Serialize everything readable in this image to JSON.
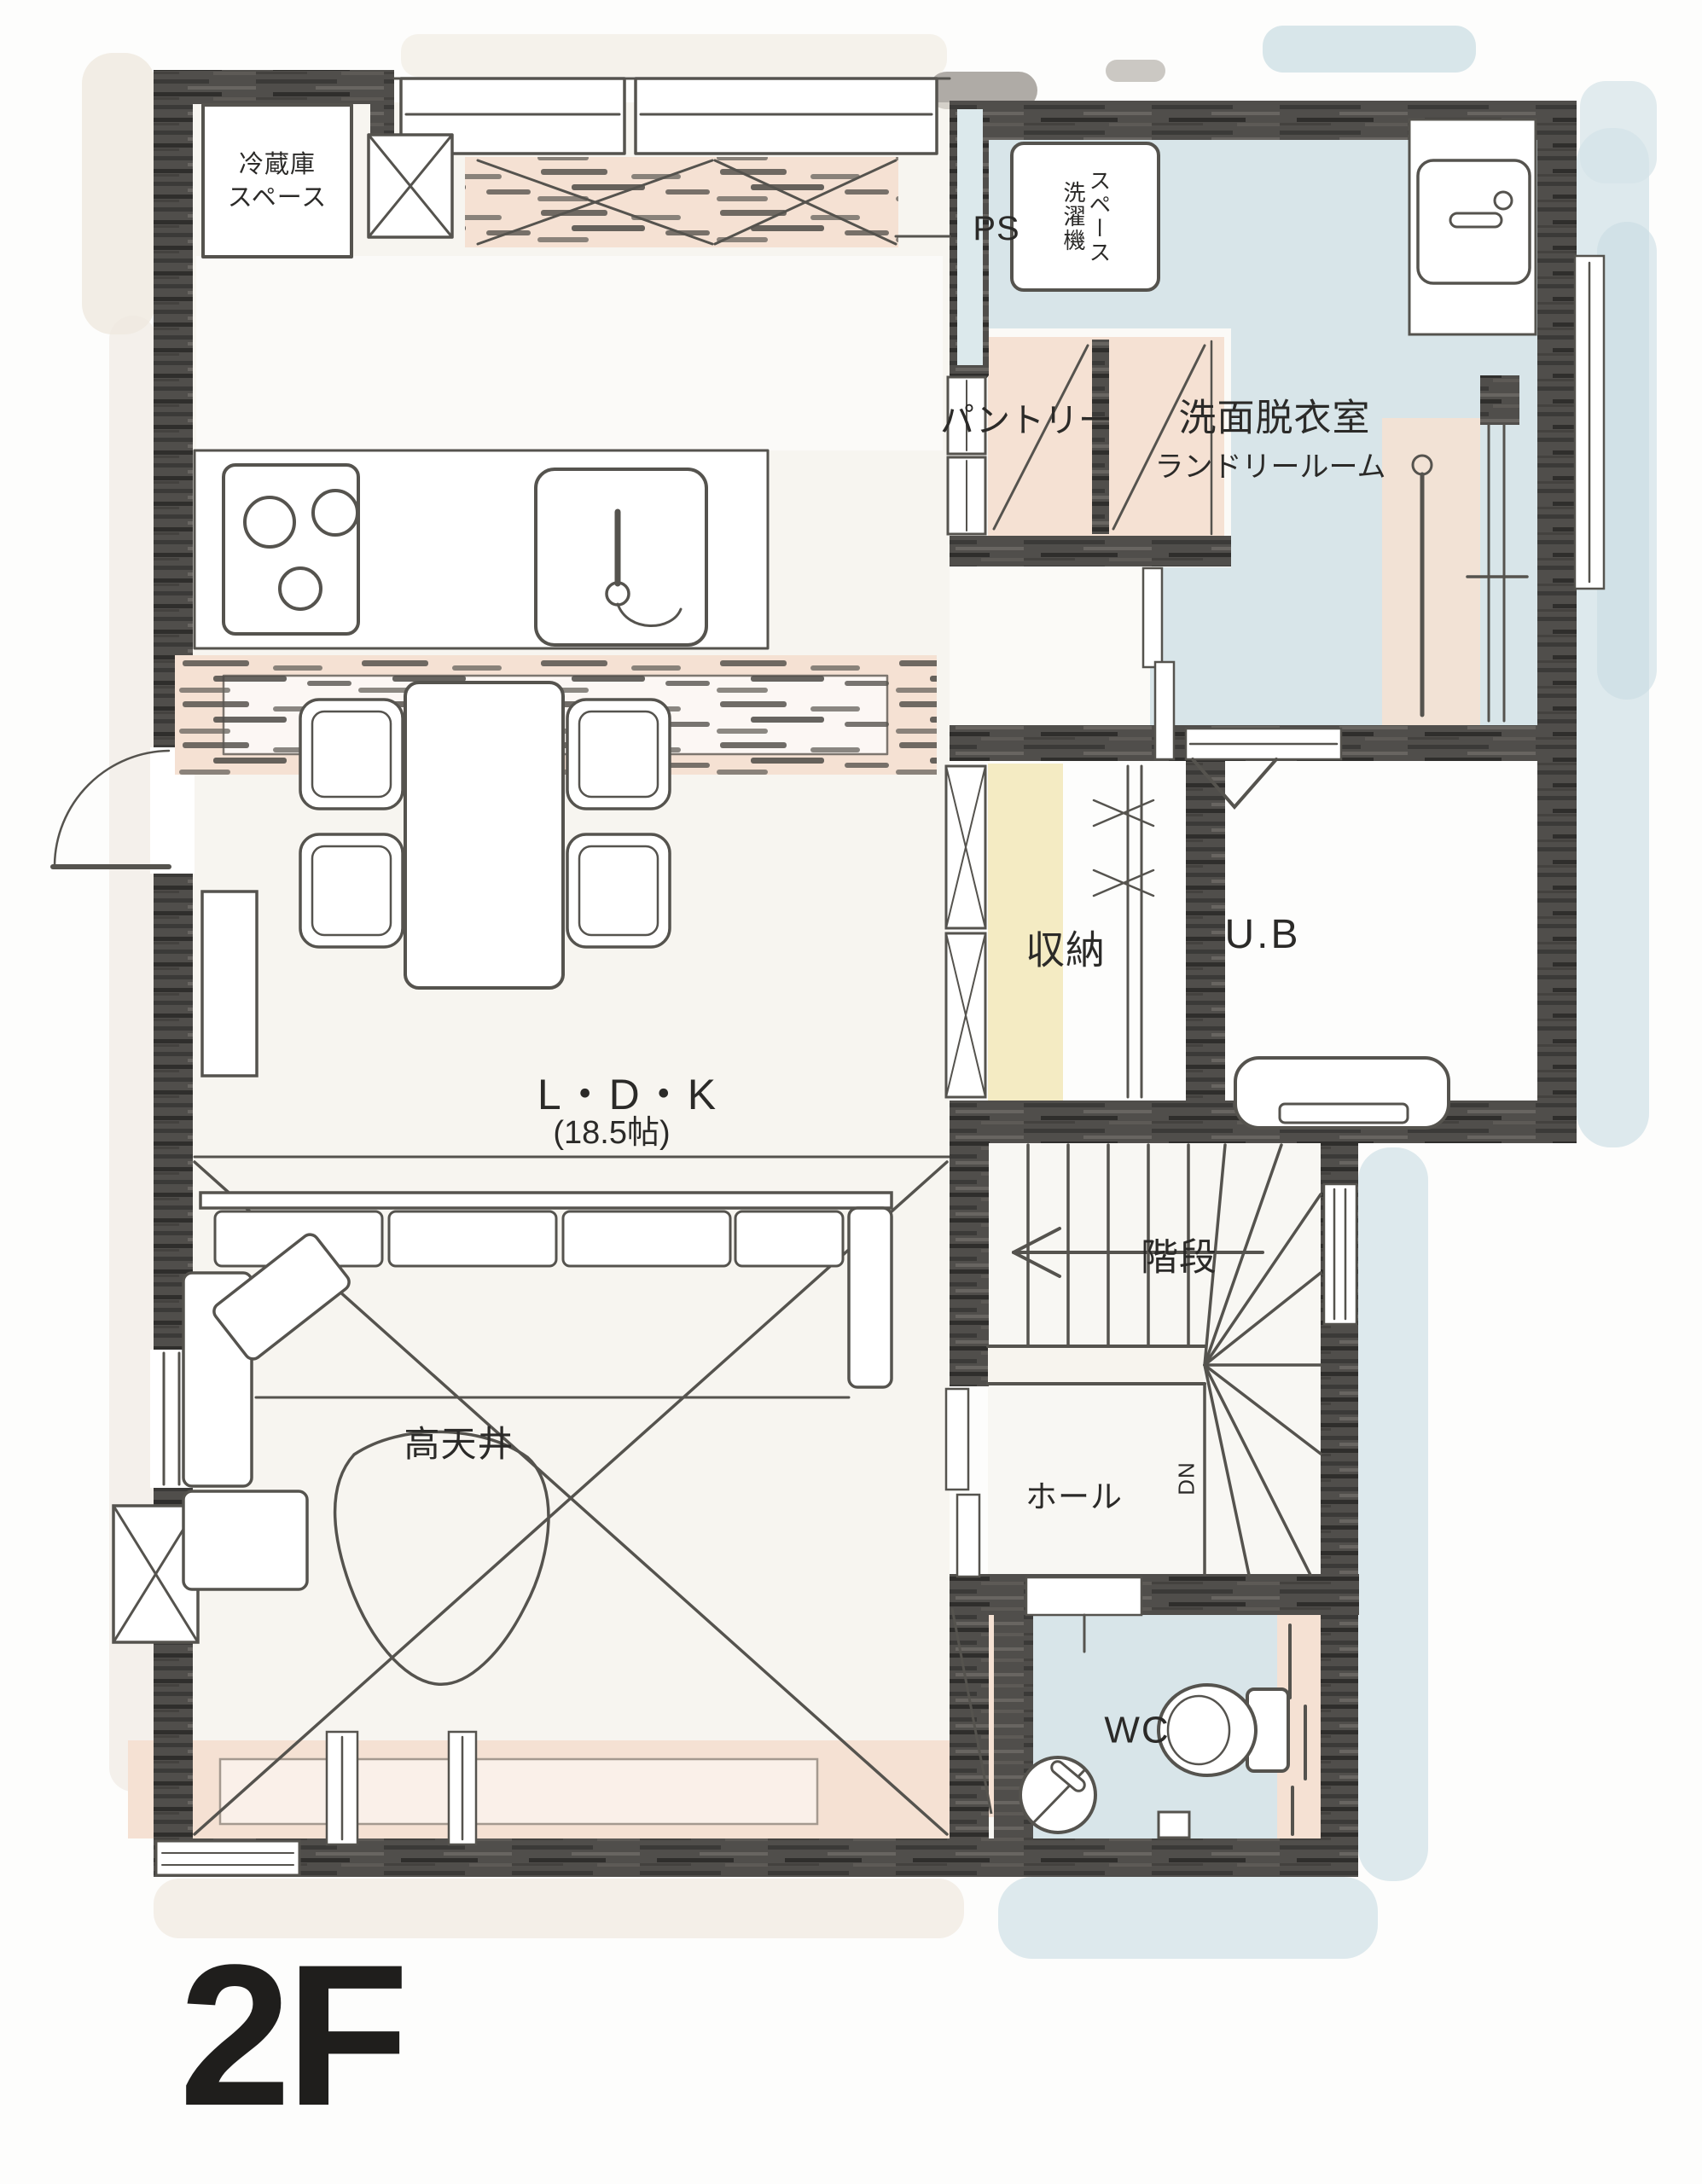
{
  "floor": {
    "label": "2F"
  },
  "rooms": {
    "ldk": {
      "name": "L・D・K",
      "size": "(18.5帖)"
    },
    "high_ceiling": "高天井",
    "stairs": "階段",
    "hall": "ホール",
    "wc": "WC",
    "storage": "収納",
    "unit_bath": "U.B",
    "pantry": "パントリー",
    "washroom": "洗面脱衣室",
    "laundry_room": "ランドリールーム",
    "pipe_space": "PS"
  },
  "fixtures": {
    "fridge_space": "冷蔵庫\nスペース",
    "washer_space": "洗濯機\nスペース",
    "stairs_down": "DN"
  },
  "colors": {
    "wall": "#4f4d4a",
    "water_blue": "#d8e5e9",
    "peach": "#f5e1d3",
    "yellow": "#f3e9bc",
    "line": "#55534e",
    "text": "#2b2a28",
    "floor_tint": "#f2eee6"
  }
}
